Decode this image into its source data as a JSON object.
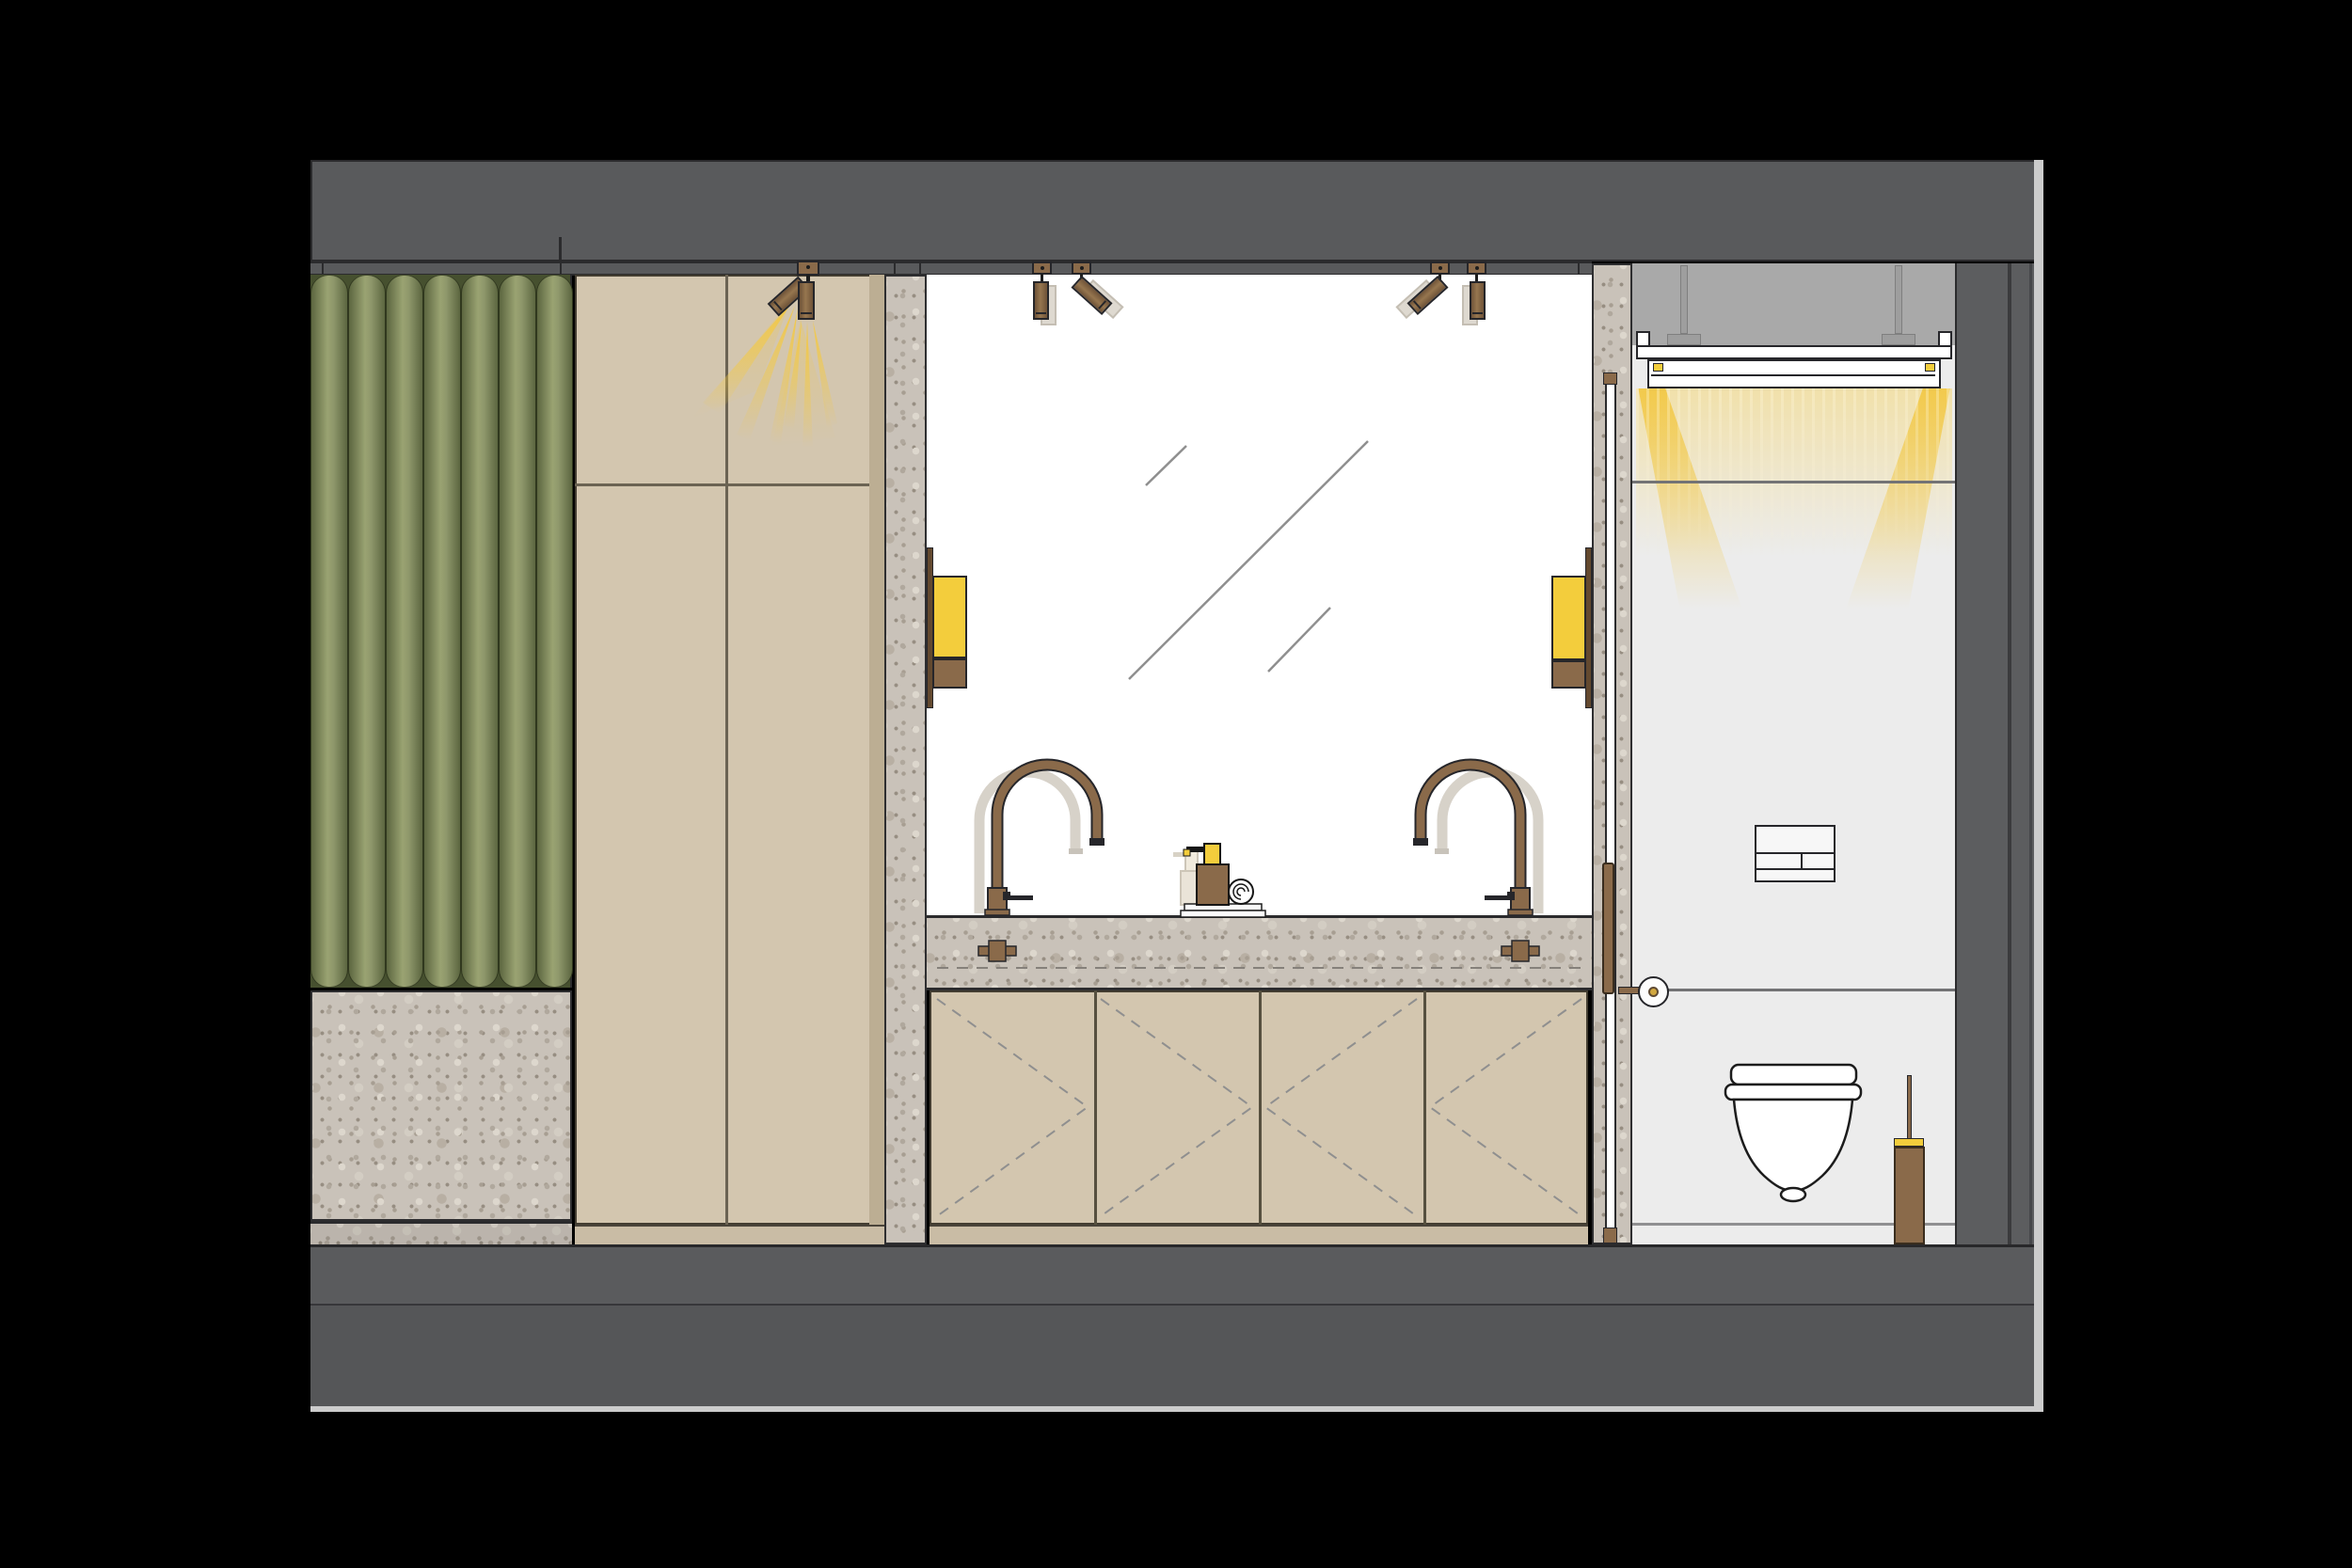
{
  "meta": {
    "title": "Bathroom interior elevation / section drawing",
    "drawing_type": "architectural-elevation",
    "text_content": "none (drawing contains no visible text or numbers)"
  },
  "palette": {
    "background": "#000000",
    "structure": "#595a5c",
    "line": "#2b2b2d",
    "outline": "#26262a",
    "plenum": "#a9a9a9",
    "wc-wall": "#ececec",
    "mirror": "#ffffff",
    "beige": "#d3c6af",
    "beige-shadow": "#bcae93",
    "beige-joint": "#6b6353",
    "plinth": "#c9bca5",
    "curtain-dark": "#5c6640",
    "curtain-mid": "#9aa372",
    "terrazzo-base": "#c9c2b9",
    "bronze": "#8a6a4a",
    "bronze-dark": "#63492f",
    "accent-yellow": "#f3cd3c",
    "glow": "#f4c84a",
    "ghost": "#ded9d0",
    "dash": "#8f8f8f",
    "floor-top": "#5a5b5d",
    "floor-bottom": "#555658",
    "edge-light": "#cccccc"
  },
  "components": {
    "ceiling": {
      "beam": "concrete soffit band",
      "track": "recessed ceiling track with joints"
    },
    "curtain": {
      "pleats": 7,
      "color_name": "olive green"
    },
    "stone_bench": {
      "material": "terrazzo",
      "with_skirting": true
    },
    "wardrobe": {
      "panels": 4,
      "joints": {
        "vertical": 1,
        "horizontal": 1
      }
    },
    "spotlights": {
      "cabinet_fixture": {
        "heads": 2,
        "rays": true
      },
      "mirror_left_pair": {
        "heads": 2,
        "ghost_positions": 2
      },
      "mirror_right_pair": {
        "heads": 2,
        "ghost_positions": 2
      }
    },
    "sconces": {
      "count": 2,
      "shade_color": "yellow",
      "base_color": "bronze"
    },
    "mirror": {
      "reflection_lines": 3
    },
    "vanity": {
      "countertop": "terrazzo with dashed basin line",
      "faucets": {
        "count": 2,
        "finish": "bronze",
        "ghost_positions": 2,
        "valves_in_counter": 2
      },
      "soap_dispenser": {
        "body": "bronze",
        "pump": "yellow",
        "ghost_position": true
      },
      "towel_roll": true,
      "doors": 4,
      "door_swing_dashes": true
    },
    "wc_room": {
      "suspended_ceiling": {
        "hangers": 2,
        "cove_light": true,
        "leds": 2,
        "glow": true
      },
      "glass_door": {
        "wood_pull_handle": true,
        "top_cap": true,
        "bottom_cap": true
      },
      "door_knob": {
        "brass_pin": true
      },
      "flush_plate": true,
      "toilet": "wall-hung",
      "toilet_brush": {
        "holder": "bronze",
        "accent": "yellow"
      },
      "wall_joints": 2,
      "skirting": true
    },
    "walls": {
      "right_section_layers": 3
    },
    "floor": {
      "layers": 2,
      "cut_edge_highlight": true
    }
  }
}
